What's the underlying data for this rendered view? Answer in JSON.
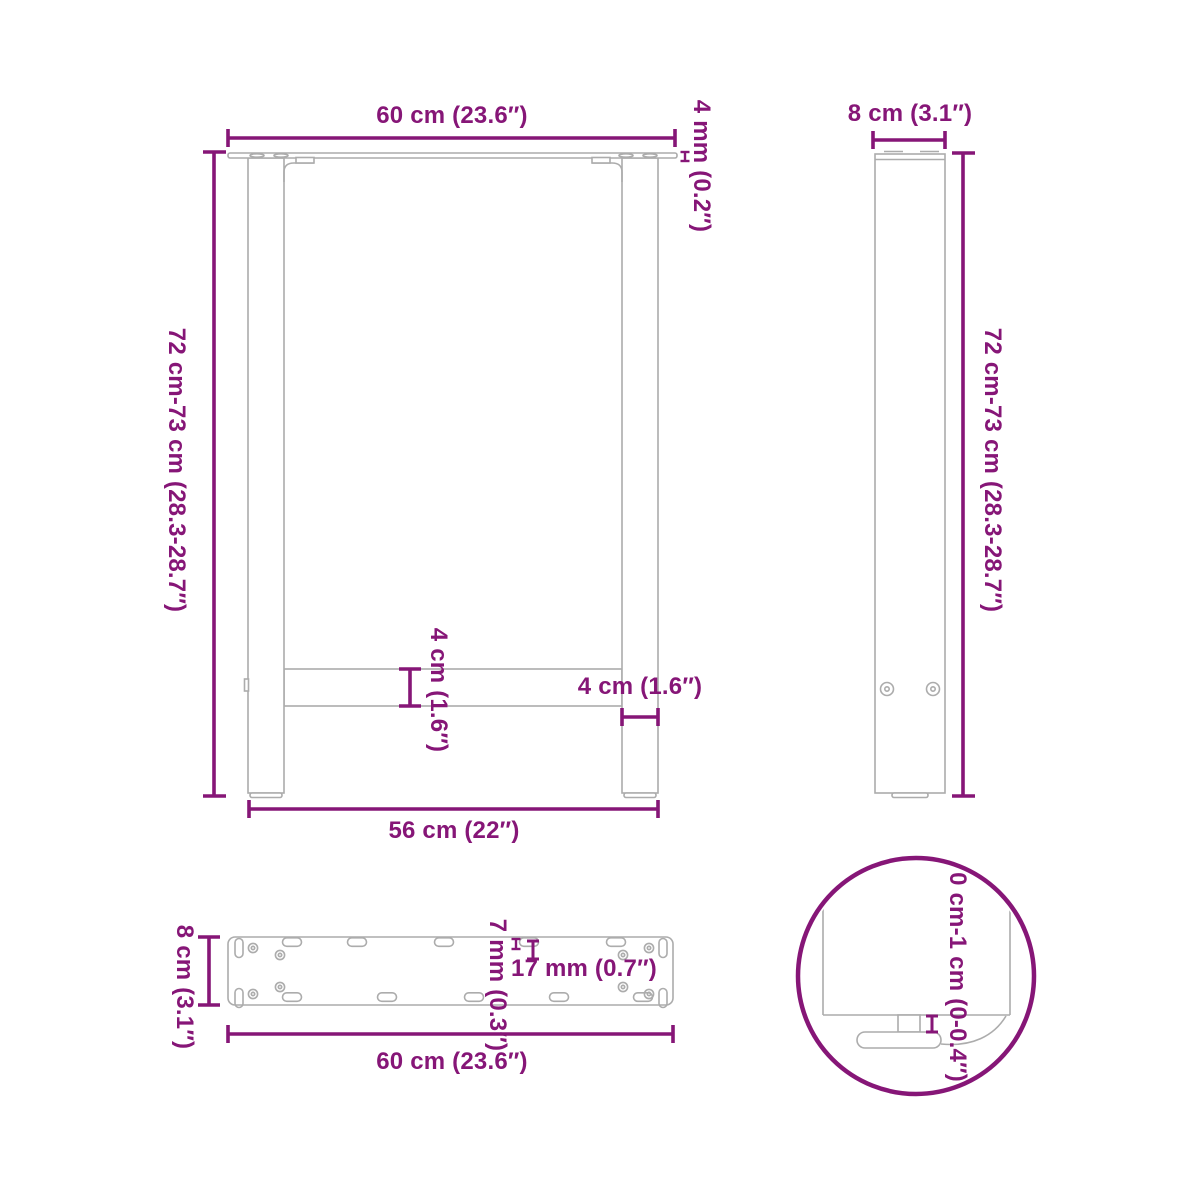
{
  "colors": {
    "dimension_purple": "#861677",
    "drawing_gray": "#ACACAC",
    "background": "#FFFFFF"
  },
  "views": {
    "front_view": {
      "width_top": "60 cm (23.6″)",
      "plate_thickness": "4 mm (0.2″)",
      "height_range": "72 cm-73 cm (28.3-28.7″)",
      "crossbar_thickness": "4 cm (1.6″)",
      "leg_width": "4 cm (1.6″)",
      "width_bottom": "56 cm (22″)"
    },
    "side_view": {
      "depth_top": "8 cm (3.1″)",
      "height_range": "72 cm-73 cm (28.3-28.7″)"
    },
    "plate_view": {
      "depth": "8 cm (3.1″)",
      "hole_width": "7 mm (0.3″)",
      "hole_length": "17 mm (0.7″)",
      "width_bottom": "60 cm (23.6″)"
    },
    "detail_view": {
      "adjustment_range": "0 cm-1 cm (0-0.4″)"
    }
  }
}
